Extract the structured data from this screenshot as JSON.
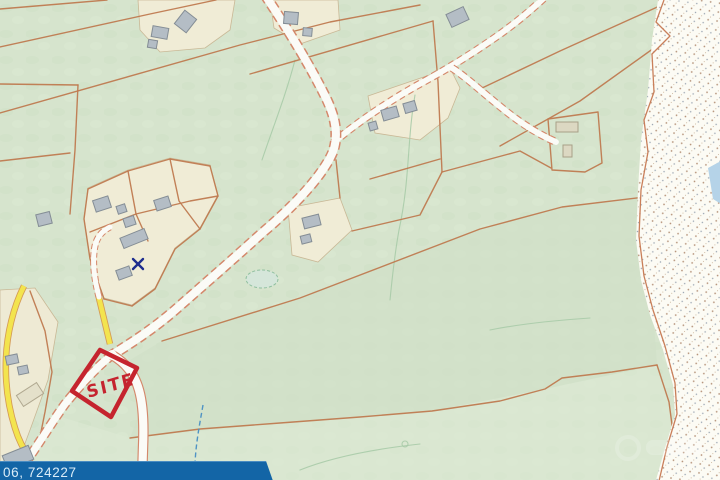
{
  "map": {
    "site_label": "SITE",
    "coords_banner_text": "06, 724227",
    "colors": {
      "field_green": "#d6e4cd",
      "parcel_beige": "#f0ecd6",
      "boundary_orange": "#bf7a50",
      "road_white": "#fbfbf7",
      "road_yellow": "#f3e44e",
      "building_gray": "#b4bdc5",
      "site_outline_red": "#c5242e",
      "banner_blue": "#1365a6",
      "banner_text": "#d9ecf8",
      "stream_blue": "#4f93c4",
      "foreshore_white": "#fcfbf4",
      "sea_blue": "#b5d3e8",
      "x_marker_blue": "#1e2d8f"
    }
  }
}
